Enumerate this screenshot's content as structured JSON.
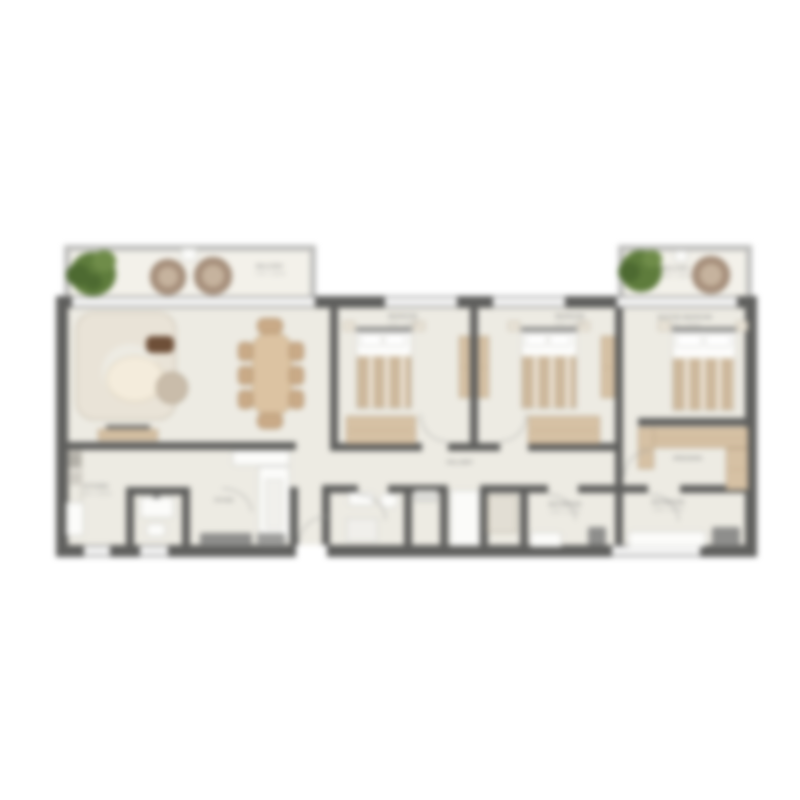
{
  "theme": {
    "bg": "#ffffff",
    "floor": "#edebe3",
    "balcony-floor": "#f3f1ea",
    "wall": "#5f5f5d",
    "balcony-wall": "#bdbdbb",
    "window-line": "#9a9a9a",
    "wood": "#d6c1a4",
    "wood-border": "#b7a184",
    "fabric": "#e9e3d7",
    "fabric-border": "#bfb5a3",
    "blanket": "#cdb89c",
    "plant": "#5e7c3c",
    "chair": "#a68f7b",
    "chair-inner": "#c6b39e",
    "table-wood": "#dcc3a2",
    "chair-wood": "#c9aa87",
    "dark-fixture": "#8e8e8c",
    "label": "#8f8f8d",
    "arc": "#a5a5a3"
  },
  "rooms": {
    "balcony_left": {
      "name": "BALCONY",
      "dims": "7.40 × 1.50 M"
    },
    "balcony_right": {
      "name": "BALCONY",
      "dims": "3.60 × 1.50 M"
    },
    "bedroom2": {
      "name": "BEDROOM",
      "dims": "3.40 × 3.30 M"
    },
    "bedroom3": {
      "name": "BEDROOM",
      "dims": "3.40 × 3.30 M"
    },
    "master": {
      "name": "MASTER BEDROOM",
      "dims": "3.60 × 3.40 M"
    },
    "kitchen": {
      "name": "KITCHEN",
      "dims": "2.00 × 2.90 M"
    },
    "foyer": {
      "name": "FOYER",
      "dims": ""
    },
    "hallway": {
      "name": "HALLWAY",
      "dims": ""
    },
    "bathroom_hall": {
      "name": "BATHROOM",
      "dims": "2.30 × 1.60 M"
    },
    "bathroom_master": {
      "name": "BATHROOM",
      "dims": "2.30 × 1.60 M"
    },
    "dressing": {
      "name": "DRESSING",
      "dims": ""
    }
  }
}
